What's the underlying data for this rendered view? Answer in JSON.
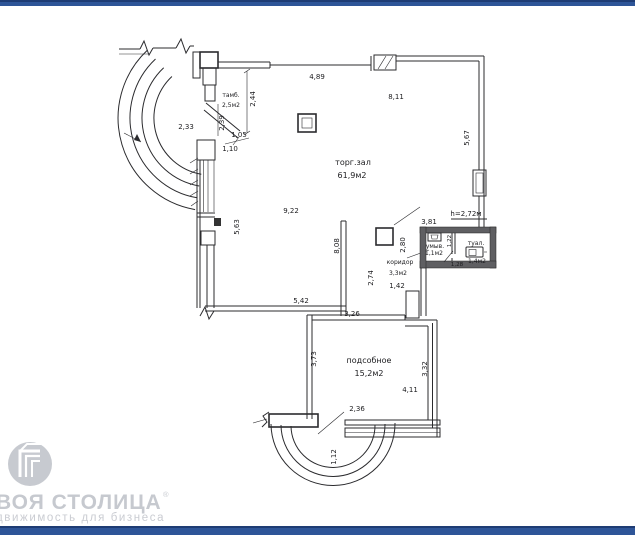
{
  "page": {
    "background": "#ffffff",
    "bar_color": "#2e5598",
    "bar_edge_color": "#1e3c74"
  },
  "branding": {
    "logo_icon": "building-in-circle",
    "title_visible": "ВОЯ СТОЛИЦА",
    "reg_mark": "®",
    "subtitle_visible": "движимость для бизнеса",
    "text_color": "#c6c9cf"
  },
  "plan": {
    "ceiling_height": "h=2,72м",
    "rooms": {
      "tambour": {
        "label": "тамб.",
        "area": "2,5м2"
      },
      "hall": {
        "label": "торг.зал",
        "area": "61,9м2"
      },
      "corridor": {
        "label": "коридор",
        "area": "3,3м2"
      },
      "washroom": {
        "label": "умыв.",
        "area": "1,1м2"
      },
      "toilet": {
        "label": "туал.",
        "area": "1,4м2"
      },
      "utility": {
        "label": "подсобное",
        "area": "15,2м2"
      }
    },
    "dims": {
      "top_wall": "4,89",
      "hall_width_top": "8,11",
      "right_wall": "5,67",
      "arc_left": "2,33",
      "tambour_depth": "2,44",
      "tambour_inner": "2,39",
      "opening_a": "1,05",
      "opening_b": "1,10",
      "hall_length": "9,22",
      "left_wall": "5,63",
      "hall_mid": "8,08",
      "corridor_right": "2,80",
      "corridor_left": "2,74",
      "corridor_width": "1,42",
      "bath_width": "3,81",
      "bath_inner": "1,22",
      "toilet_width": "1,28",
      "hall_bottom": "5,42",
      "utility_top": "3,26",
      "utility_left": "3,73",
      "utility_right": "3,32",
      "utility_width": "4,11",
      "utility_opening": "2,36",
      "bay_depth": "1,12"
    }
  }
}
